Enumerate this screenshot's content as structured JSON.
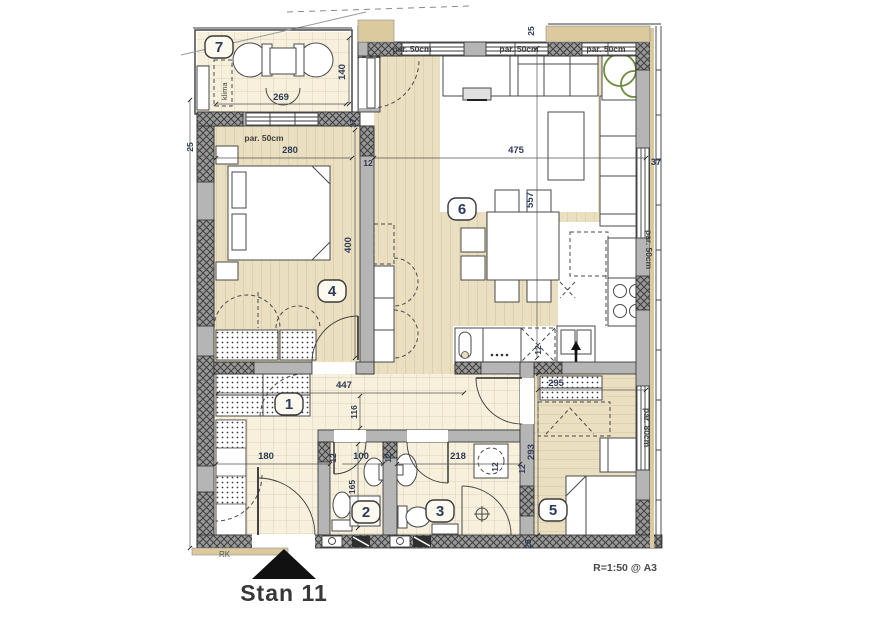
{
  "meta": {
    "title": "Stan 11",
    "scale_note": "R=1:50 @ A3",
    "corner_label": "RK"
  },
  "rooms": {
    "r1": "1",
    "r2": "2",
    "r3": "3",
    "r4": "4",
    "r5": "5",
    "r6": "6",
    "r7": "7"
  },
  "labels": {
    "par50": "par. 50cm",
    "par80": "par. 80cm",
    "klima": "klima"
  },
  "dims": {
    "d12": "12",
    "d25": "25",
    "d37": "37",
    "d100": "100",
    "d116": "116",
    "d140": "140",
    "d165": "165",
    "d180": "180",
    "d218": "218",
    "d269": "269",
    "d280": "280",
    "d293": "293",
    "d295": "295",
    "d400": "400",
    "d447": "447",
    "d475": "475",
    "d557": "557"
  },
  "colors": {
    "floor_wood": "#ebdfc1",
    "floor_tile": "#f7f0dc",
    "wall_gray": "#b5b5b5",
    "hatch_dark": "#3f3f3f",
    "facade_tan": "#dcca9f",
    "dim_text": "#2e3a55",
    "plant_green": "#6e8d3e"
  }
}
